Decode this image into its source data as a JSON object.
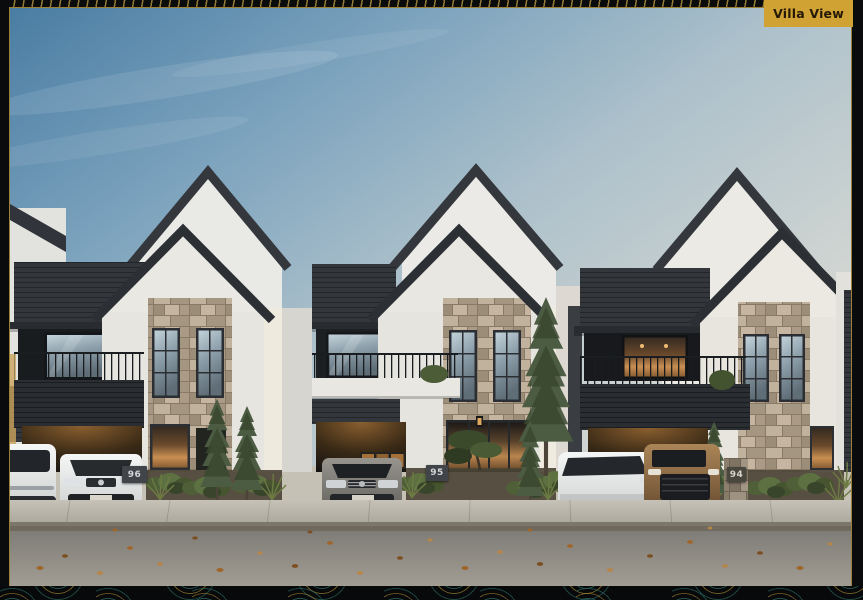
{
  "badge": {
    "label": "Villa View"
  },
  "villas": [
    {
      "number": "96"
    },
    {
      "number": "95"
    },
    {
      "number": "94"
    }
  ],
  "colors": {
    "badge_bg": "#d0a133",
    "badge_text": "#241806",
    "frame_black": "#0a0b0c",
    "frame_gold_accent": "#9c8038",
    "frame_teal_accent": "#2b5f58",
    "sky_top": "#4a7da3",
    "sky_horizon": "#d6d8d3",
    "wall_white": "#e9e8e4",
    "cladding_charcoal": "#33373c",
    "stone_cladding": "#b2a28f",
    "warm_window_glow": "#c98f52",
    "road_asphalt": "#8d8a83"
  }
}
